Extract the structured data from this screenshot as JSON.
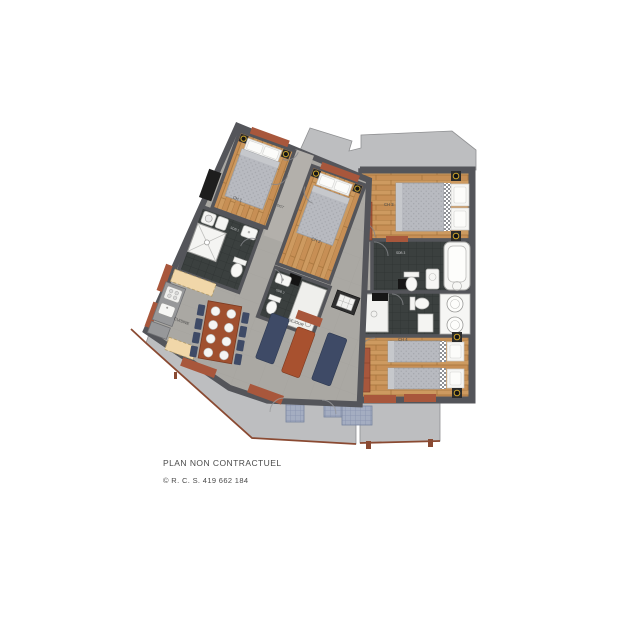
{
  "plan": {
    "title": "apartment-floor-plan",
    "rooms": {
      "ch1": {
        "label": "CH 1"
      },
      "ch2": {
        "label": "CH 2"
      },
      "ch3": {
        "label": "CH 3"
      },
      "ch4": {
        "label": "CH 4"
      },
      "sdb1": {
        "label": "SDB 1"
      },
      "sdb2": {
        "label": "SDB 2"
      },
      "sdb3": {
        "label": "SDB 3"
      },
      "dgt": {
        "label": "DGT"
      },
      "cuisine": {
        "label": "CUISINE"
      },
      "sejour": {
        "label": "SEJOUR"
      }
    },
    "colors": {
      "wood": "#c78f55",
      "dark_tile": "#3b403f",
      "wall": "#54555a",
      "terrace": "#bdbec0",
      "living_floor": "#aaa8a3",
      "terracotta": "#a8573c",
      "navy": "#3e4a66",
      "rust": "#a0502f",
      "gold": "#c9a22c"
    }
  },
  "footer": {
    "line1": "PLAN NON CONTRACTUEL",
    "line2": "© R. C. S. 419 662 184"
  }
}
